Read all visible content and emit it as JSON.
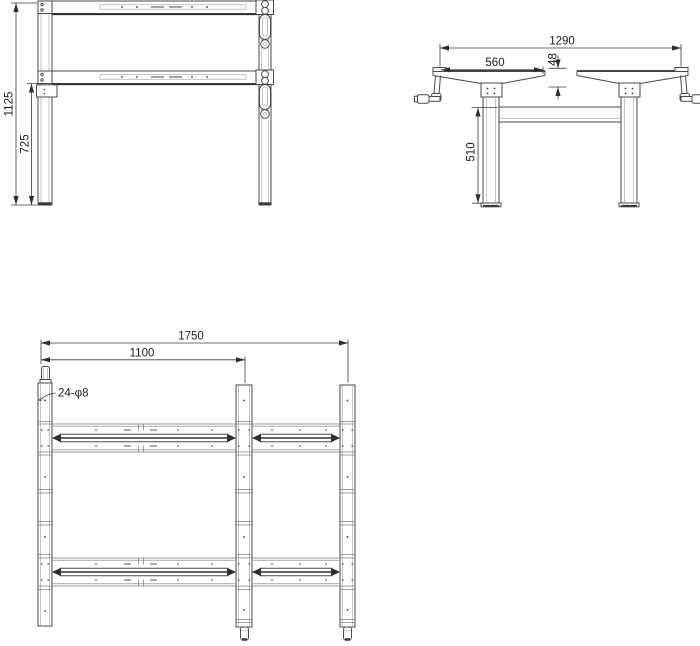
{
  "drawing": {
    "views": {
      "front": {
        "dim_total_height": "1125",
        "dim_frame_height": "725"
      },
      "side": {
        "dim_overall_width": "1290",
        "dim_top_bracket_width": "560",
        "dim_top_offset": "48",
        "dim_leg_height": "510"
      },
      "plan": {
        "dim_overall_length": "1750",
        "dim_beam_length": "1100",
        "callout_holes": "24-φ8"
      }
    },
    "colors": {
      "background": "#ffffff",
      "line": "#4a4a4a",
      "accent_dark": "#2e2e2e",
      "text": "#1c1c1c"
    }
  }
}
